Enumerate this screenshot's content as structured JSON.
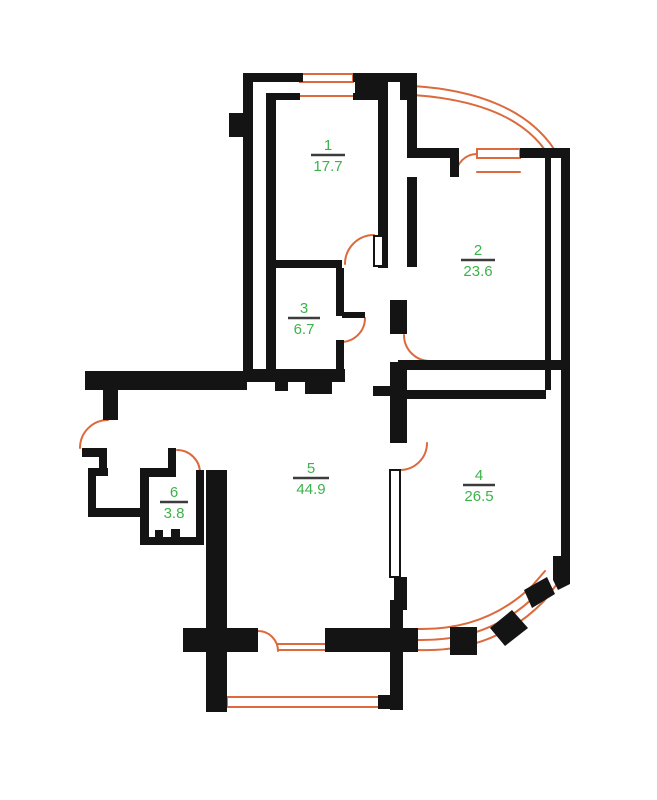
{
  "plan": {
    "rooms": [
      {
        "number": "1",
        "area": "17.7"
      },
      {
        "number": "2",
        "area": "23.6"
      },
      {
        "number": "3",
        "area": "6.7"
      },
      {
        "number": "4",
        "area": "26.5"
      },
      {
        "number": "5",
        "area": "44.9"
      },
      {
        "number": "6",
        "area": "3.8"
      }
    ],
    "colors": {
      "wall": "#141414",
      "opening": "#dc6a3c",
      "label_green": "#3cb24a",
      "divider_line": "#3c3c3c",
      "background": "#ffffff"
    }
  }
}
